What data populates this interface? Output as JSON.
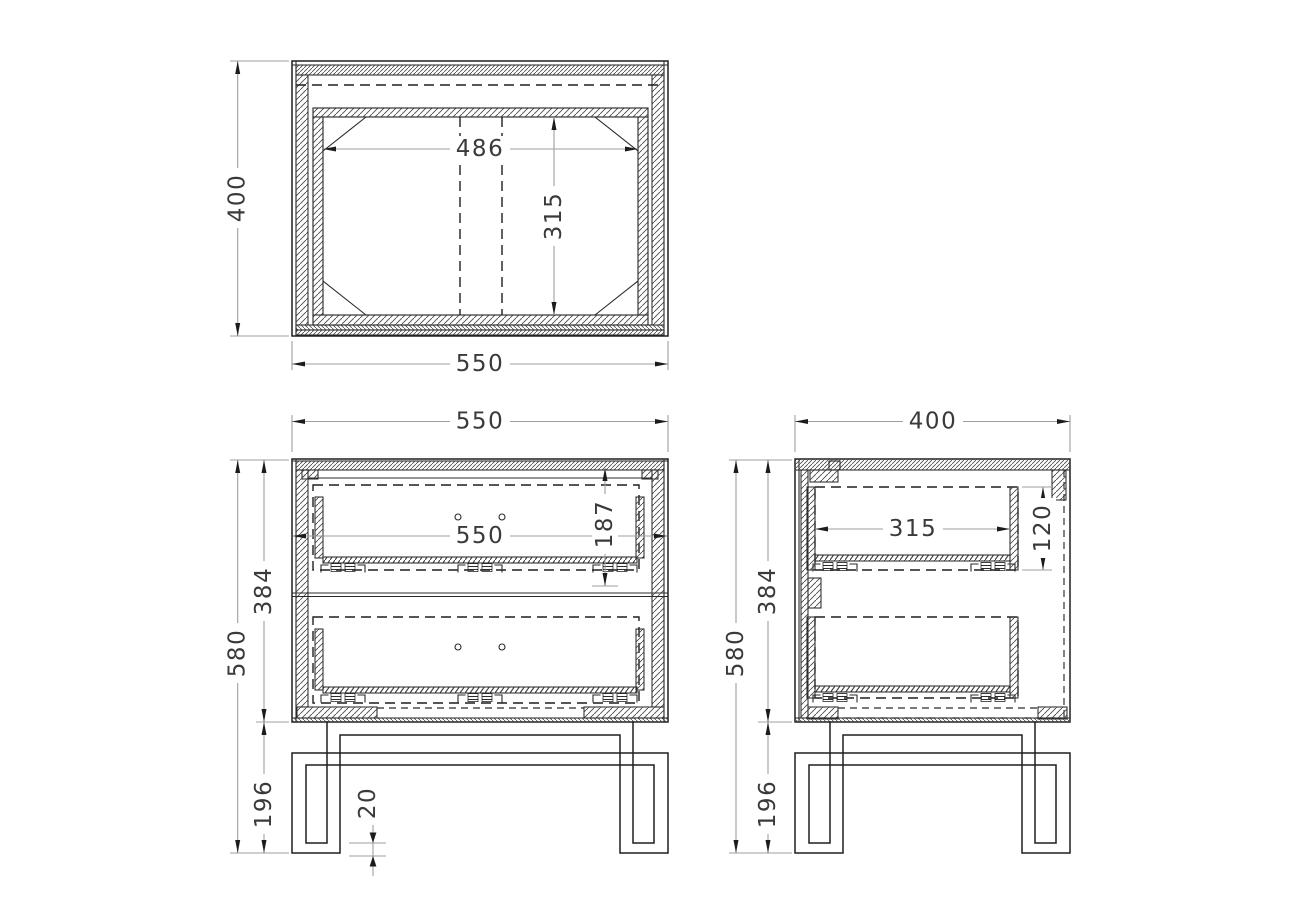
{
  "drawing": {
    "type": "furniture technical drawing - 2-drawer nightstand, three orthographic views",
    "colors": {
      "background": "#ffffff",
      "line": "#1f1f1f",
      "dimension_line": "#9f9f9f",
      "text": "#3a3a3a"
    },
    "dimensions": {
      "top_view": {
        "depth": "400",
        "width": "550",
        "inner_width": "486",
        "inner_depth": "315"
      },
      "front_view": {
        "overall_width": "550",
        "interior_width": "550",
        "drawer_front_height": "187",
        "cabinet_height": "384",
        "overall_height": "580",
        "leg_height": "196",
        "leg_tube_thickness": "20"
      },
      "side_view": {
        "overall_depth": "400",
        "drawer_depth": "315",
        "drawer_box_height": "120",
        "cabinet_height": "384",
        "overall_height": "580",
        "leg_height": "196"
      }
    }
  }
}
